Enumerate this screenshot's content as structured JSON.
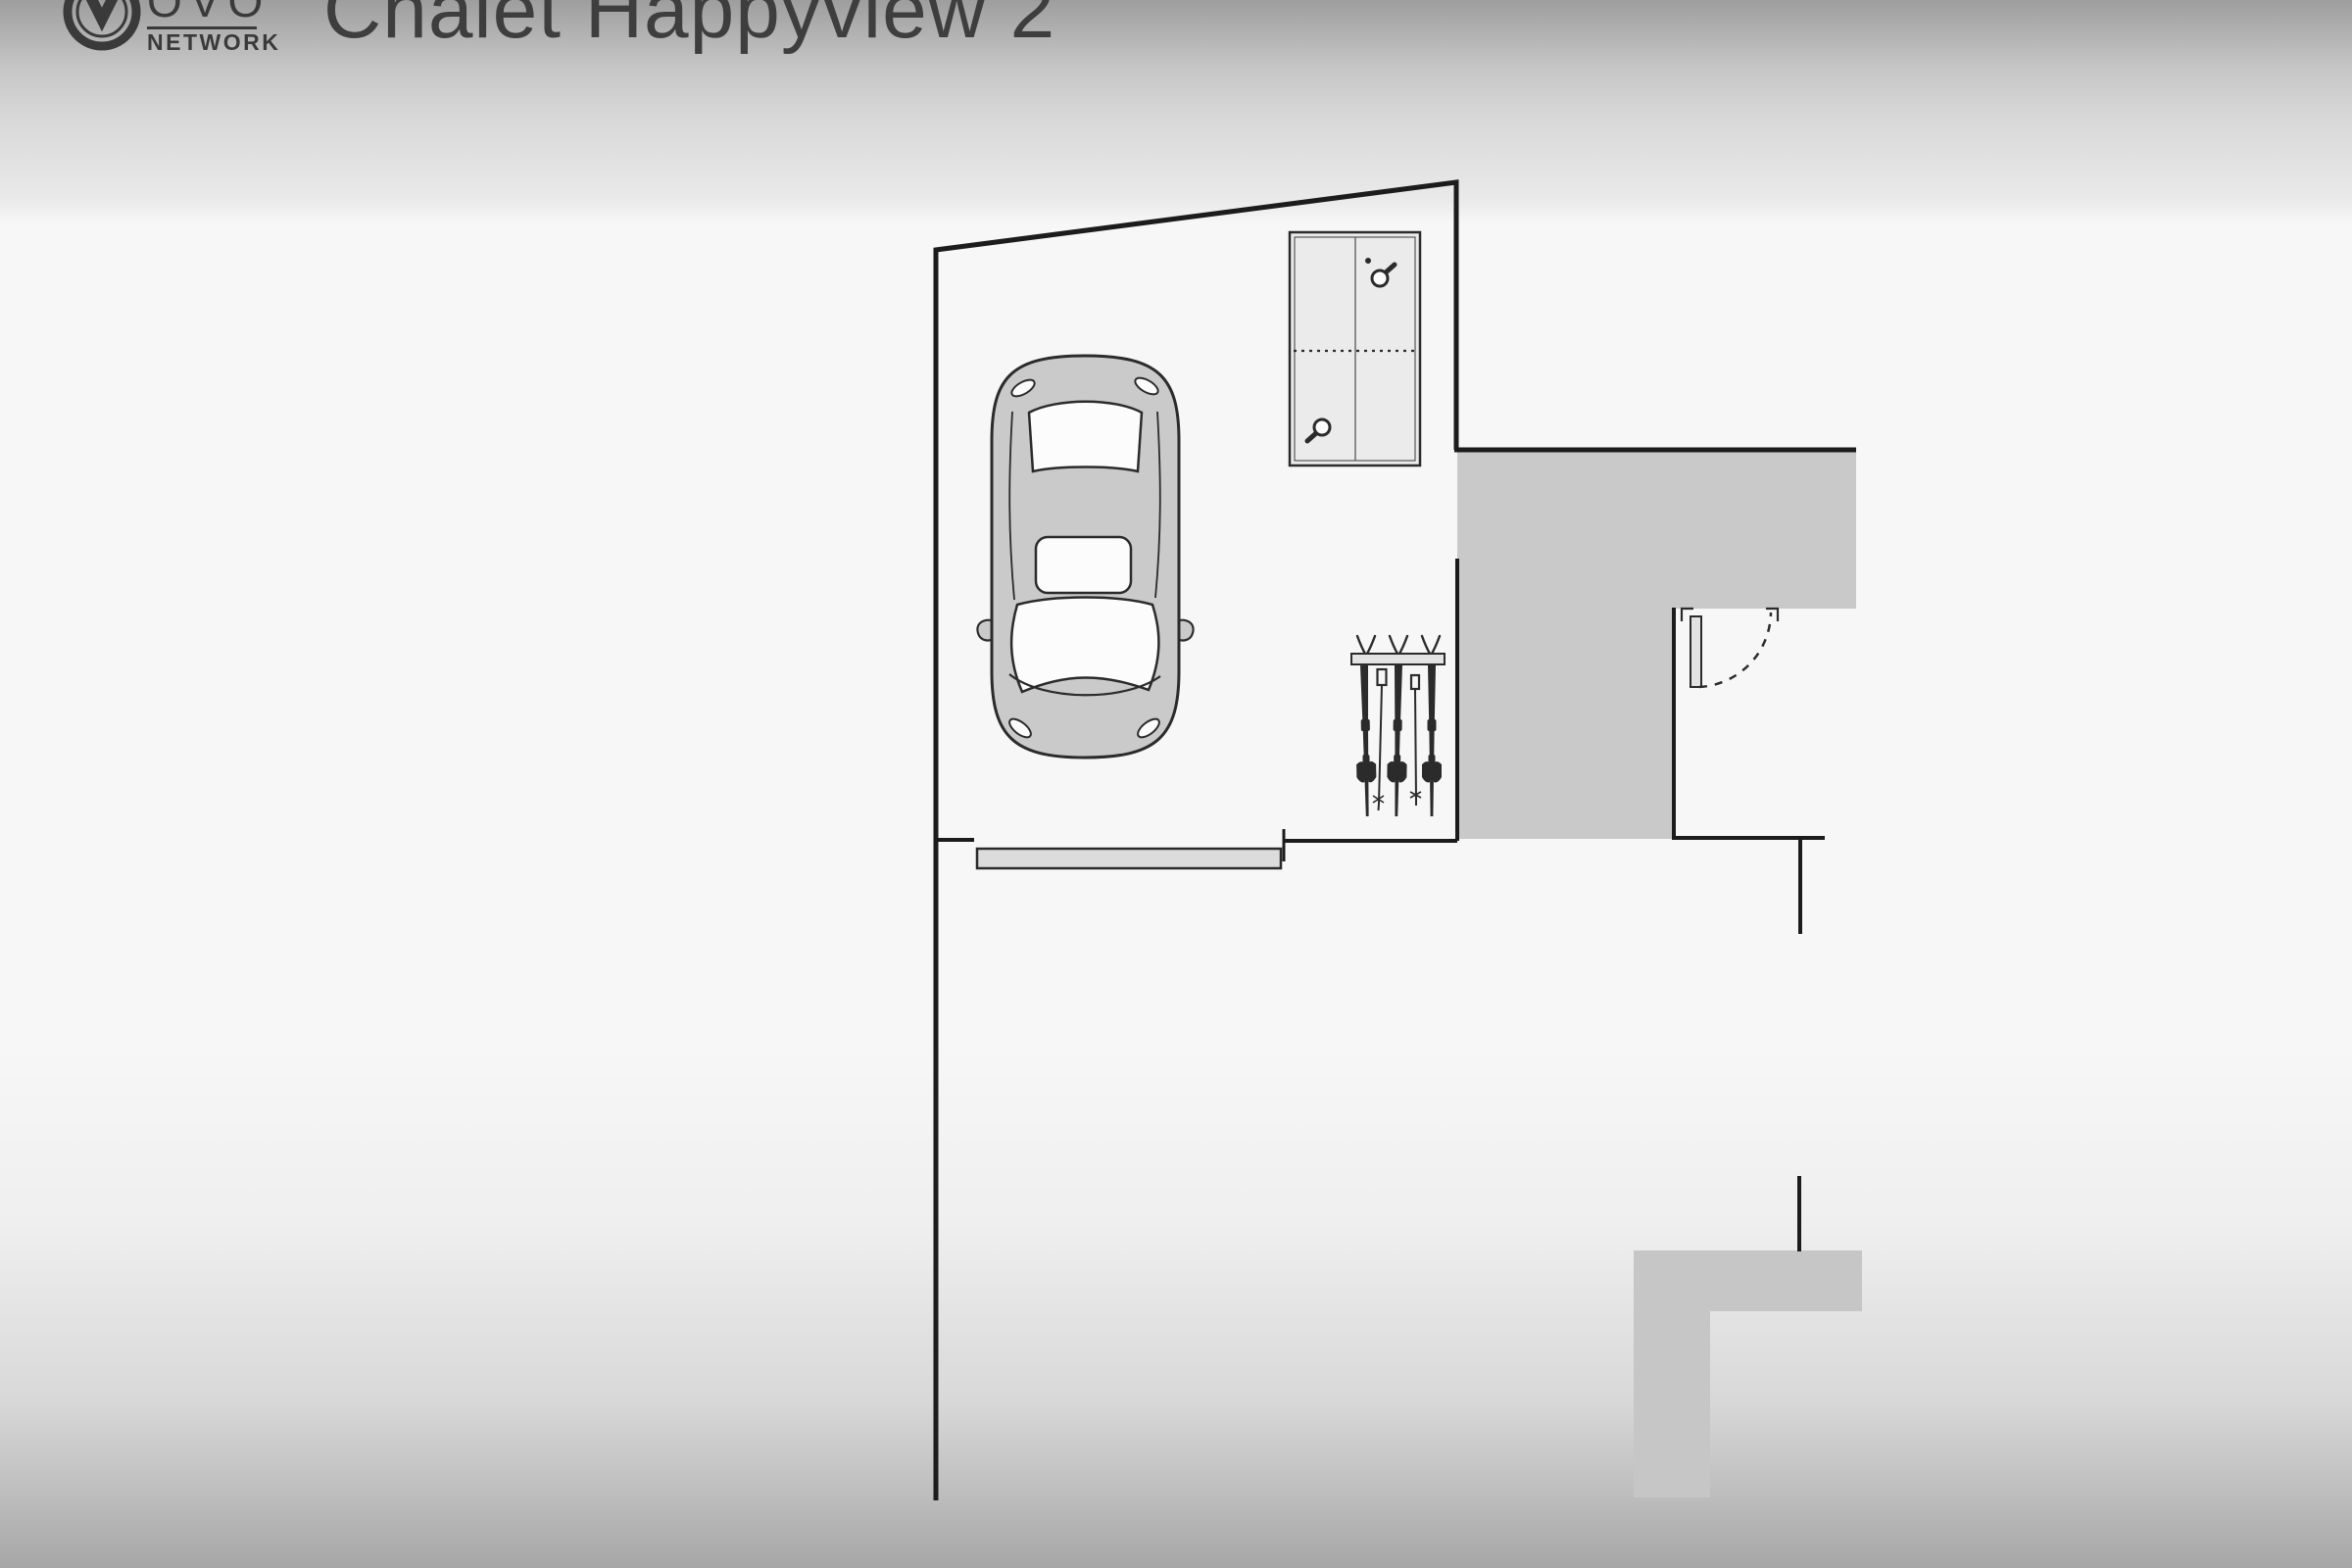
{
  "header": {
    "logo": {
      "ovo": "OVO",
      "network": "NETWORK"
    },
    "title": "Chalet Happyview 2"
  },
  "icons": [
    "ovo-network-emblem",
    "car-top-view",
    "ping-pong-table",
    "ping-pong-paddle",
    "ping-pong-ball",
    "ski-rack",
    "ski",
    "ski-pole",
    "garage-door",
    "door-leaf",
    "door-swing-arc"
  ],
  "colors": {
    "wall": "#1c1c1c",
    "area-fill": "#c9c9c9",
    "terrace-fill": "#c6c6c6",
    "object-fill": "#ebebeb",
    "car-fill": "#cacaca",
    "door-leaf-fill": "#e2e2e2",
    "garage-door-fill": "#dcdcdc",
    "ink": "#2b2b2b",
    "logo": "#3a3a3a",
    "title": "#3e3e3e",
    "bg-top": "#9e9e9e",
    "bg-light": "#f7f7f7",
    "bg-bottom": "#a6a6a6"
  }
}
